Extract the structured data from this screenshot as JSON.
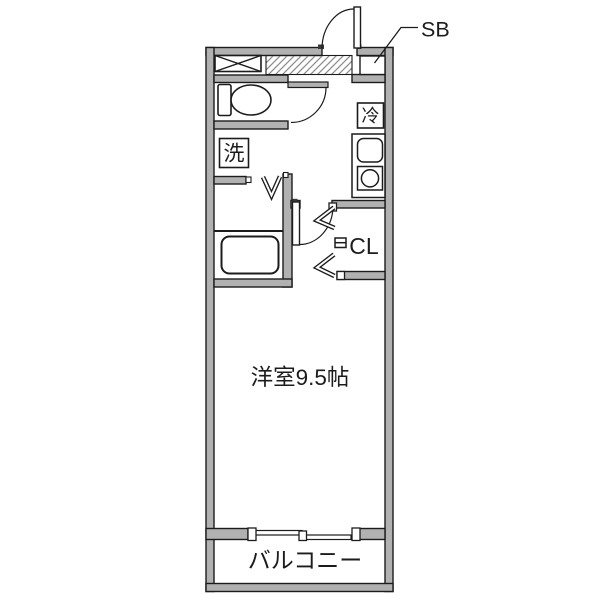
{
  "floorplan": {
    "entrance": {
      "shoe_box_label": "SB"
    },
    "kitchen": {
      "refrigerator_label": "冷"
    },
    "washroom": {
      "washer_label": "洗"
    },
    "closet": {
      "label": "CL"
    },
    "main_room": {
      "label": "洋室9.5帖"
    },
    "balcony": {
      "label": "バルコニー"
    }
  },
  "colors": {
    "wall_fill": "#b1b1b1",
    "line": "#1c1c1c",
    "background": "#ffffff",
    "hatch": "#8a8a8a"
  }
}
